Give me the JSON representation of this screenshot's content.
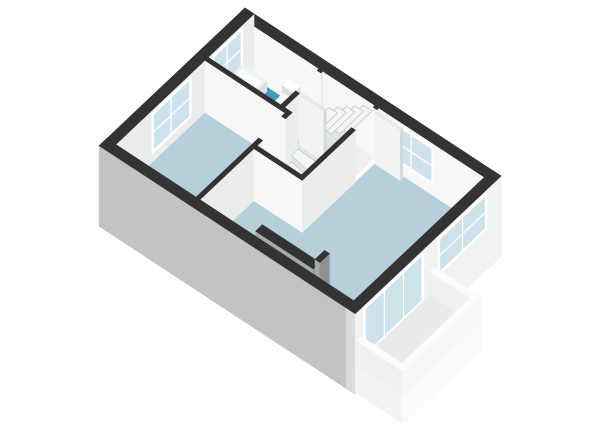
{
  "scene": {
    "description": "3D axonometric floor plan of an apartment upper floor, no text labels",
    "background": "#ffffff"
  },
  "rooms": [
    {
      "id": "bathroom",
      "floor": "#3d9dbd"
    },
    {
      "id": "bedroom1",
      "floor": "#b6cfda"
    },
    {
      "id": "hall",
      "floor": "#eff1f1"
    },
    {
      "id": "bedroom2",
      "floor": "#b6cfda"
    },
    {
      "id": "balcony",
      "floor": "#e9ebec"
    }
  ],
  "colors": {
    "background": "#ffffff",
    "wall_top": "#333333",
    "wall_int_front": "#f7f7f7",
    "wall_int_right": "#ebecec",
    "wall_ext_sw": "#c2c4c4",
    "wall_ext_se": "#f1f2f2",
    "wall_ext_end": "#d9dadb",
    "glass": "#cde2eb",
    "frame": "#ffffff",
    "fixture_top": "#eff2f2",
    "fixture_side": "#dde0e0",
    "fixture_inner": "#fbfdfd",
    "stair_top": "#f4f6f6",
    "stair_riser": "#e1e4e4",
    "stair_edge": "#c6c9c9",
    "chimney_front": "#a6aaab",
    "chimney_right": "#8e9293",
    "door_face": "#f2f3f3",
    "door_edge": "#d6d7d7",
    "door_top": "#e8e9e9",
    "parapet_top": "#fbfcfc",
    "parapet_front": "#eff1f1",
    "parapet_right": "#f7f8f8",
    "slab_front": "#f2f3f4",
    "slab_right": "#fafbfb"
  }
}
